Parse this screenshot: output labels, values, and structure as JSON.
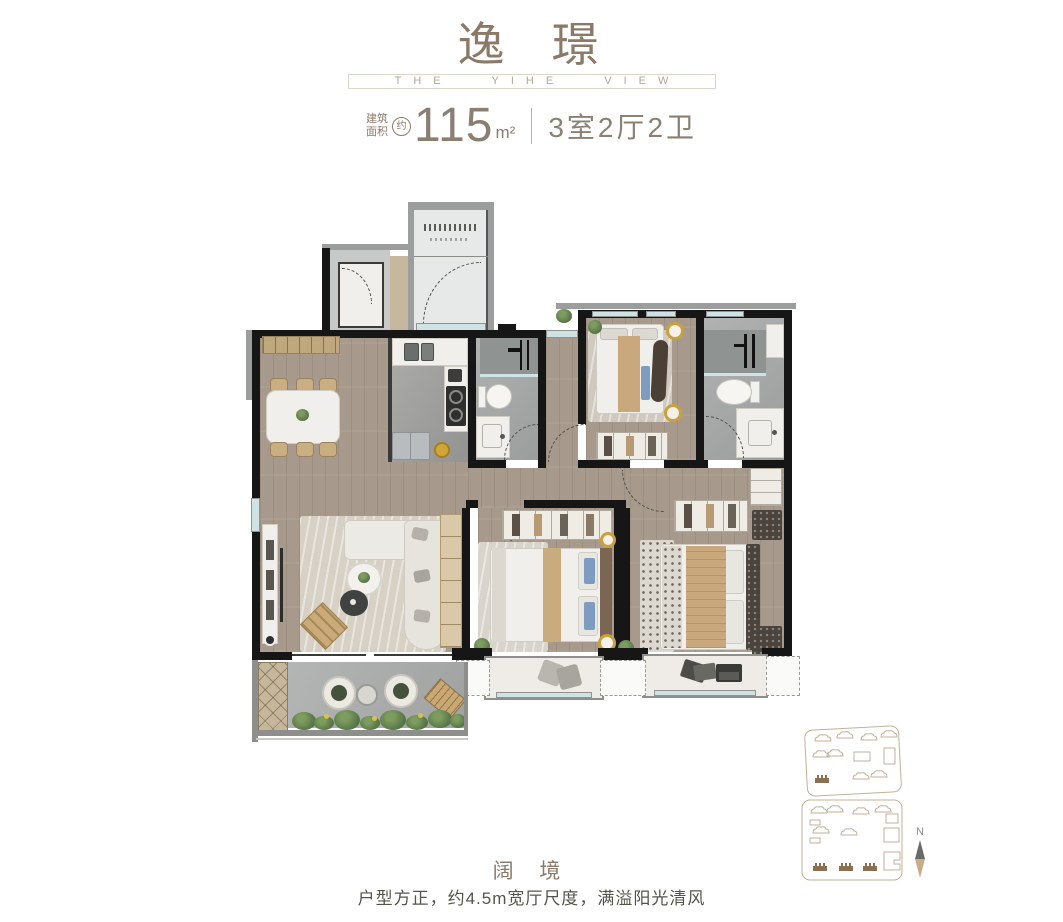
{
  "header": {
    "title": "逸 璟",
    "subtitle": "THE YIHE VIEW"
  },
  "spec": {
    "area_label_top": "建筑",
    "area_label_bottom": "面积",
    "approx_badge": "约",
    "area_value": "115",
    "area_unit": "m²",
    "layout_text": "3室2厅2卫"
  },
  "footer": {
    "headline": "阔 境",
    "description": "户型方正，约4.5m宽厅尺度，满溢阳光清风"
  },
  "compass": {
    "north_label": "N"
  },
  "colors": {
    "brand_brown": "#8b7a68",
    "subtitle_taupe": "#b3a694",
    "wall_black": "#161616",
    "wood_floor": "#a79a8c",
    "window_glass": "#cfe3e4",
    "accent_tan": "#c8a87c",
    "accent_blue": "#7d9cc0",
    "plant_green": "#5e7c4c",
    "site_outline": "#c2b198"
  }
}
